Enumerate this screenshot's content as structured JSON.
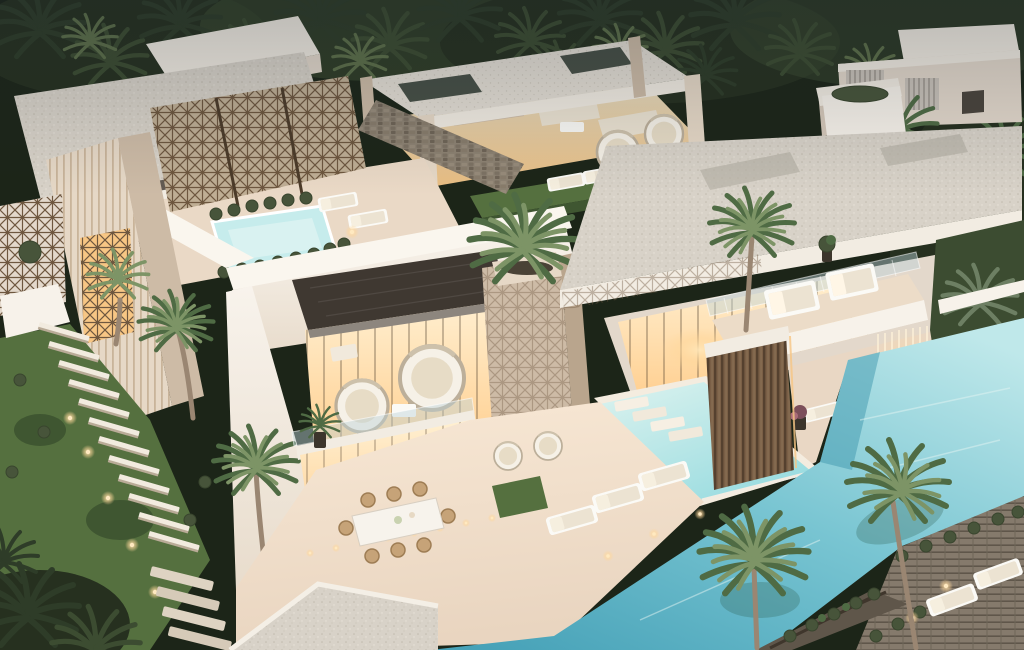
{
  "scene": {
    "type": "architectural-render",
    "description": "Aerial dusk view of a modern luxury villa with rooftop terraces, bronze lattice screens, tropical palm trees, turquoise swimming pools, sun loungers and warm-lit interiors, surrounded by dense palm forest",
    "time_of_day": "dusk",
    "view": "aerial three-quarter",
    "setting": "tropical palm forest",
    "features": [
      "rooftop pergola lounge with outdoor bar",
      "rooftop jacuzzi bordered by boxwood balls",
      "bronze geometric lattice screens",
      "dark patterned canopy over sphere-chair lounge",
      "planted travertine pillar with palm",
      "large cantilevered speckled roof",
      "balcony with two white daybeds",
      "bronze louver curtain wall",
      "cascading light strands over pool",
      "stepped mid-level pool with infinity edge",
      "large wrap-around main pool",
      "outdoor dining table with eight chairs",
      "garden staircase with bollard lights",
      "wooden pool deck with white loungers",
      "vine-covered trellis walkway",
      "neighboring white villa among palms"
    ],
    "counts": {
      "pools": 3,
      "balcony_daybeds": 2,
      "sphere_chairs": 2,
      "dining_chairs": 8,
      "main_deck_loungers": 3
    }
  },
  "palette": {
    "forest-deep": "#1c2518",
    "forest-dark": "#26301f",
    "forest-mid": "#3c4c31",
    "palm-green": "#4f6b44",
    "palm-light": "#7d9466",
    "palm-gray": "#6d7f63",
    "trunk": "#9a8672",
    "roof-speckle": "#d8d2c8",
    "roof-dot": "#c2bbae",
    "roof-light": "#e4ded4",
    "fascia": "#f2ece2",
    "wall-white": "#f7f2ea",
    "wall-shadow": "#e3d8cb",
    "wall-dim": "#d5c8b9",
    "travertine": "#e6d8c6",
    "travertine-dark": "#cdbba6",
    "stripe": "#c9b49a",
    "bronze": "#6e573f",
    "bronze-dark": "#4c3b29",
    "stone-wall": "#8d8272",
    "canopy-dark": "#3f3831",
    "canopy-edge": "#8d867e",
    "glow-warm": "#ffe2b0",
    "glow-deep": "#f7c684",
    "pool-light": "#c6ecec",
    "pool-mid": "#8fd4da",
    "pool-deep": "#47a2b8",
    "pool-shadow": "#3f98ad",
    "grass": "#55703f",
    "grass-dark": "#3f5631",
    "bush": "#47543a",
    "cushion": "#ece3d2",
    "glass": "#bcd3da",
    "wood-deck": "#857a6c",
    "wood-dark": "#5f564a",
    "light-dot": "#ffe9c0"
  },
  "elements": {
    "villa": {
      "label": "Main modern villa"
    },
    "neighbor_house": {
      "label": "Neighboring white villa"
    },
    "rooftop_jacuzzi": {
      "label": "Rooftop jacuzzi pool"
    },
    "main_pool": {
      "label": "Main swimming pool"
    },
    "mid_pool": {
      "label": "Mid-level stepped pool"
    },
    "dining": {
      "label": "Outdoor dining set"
    },
    "garden": {
      "label": "Side garden with staircase"
    },
    "forest": {
      "label": "Palm forest backdrop"
    }
  }
}
